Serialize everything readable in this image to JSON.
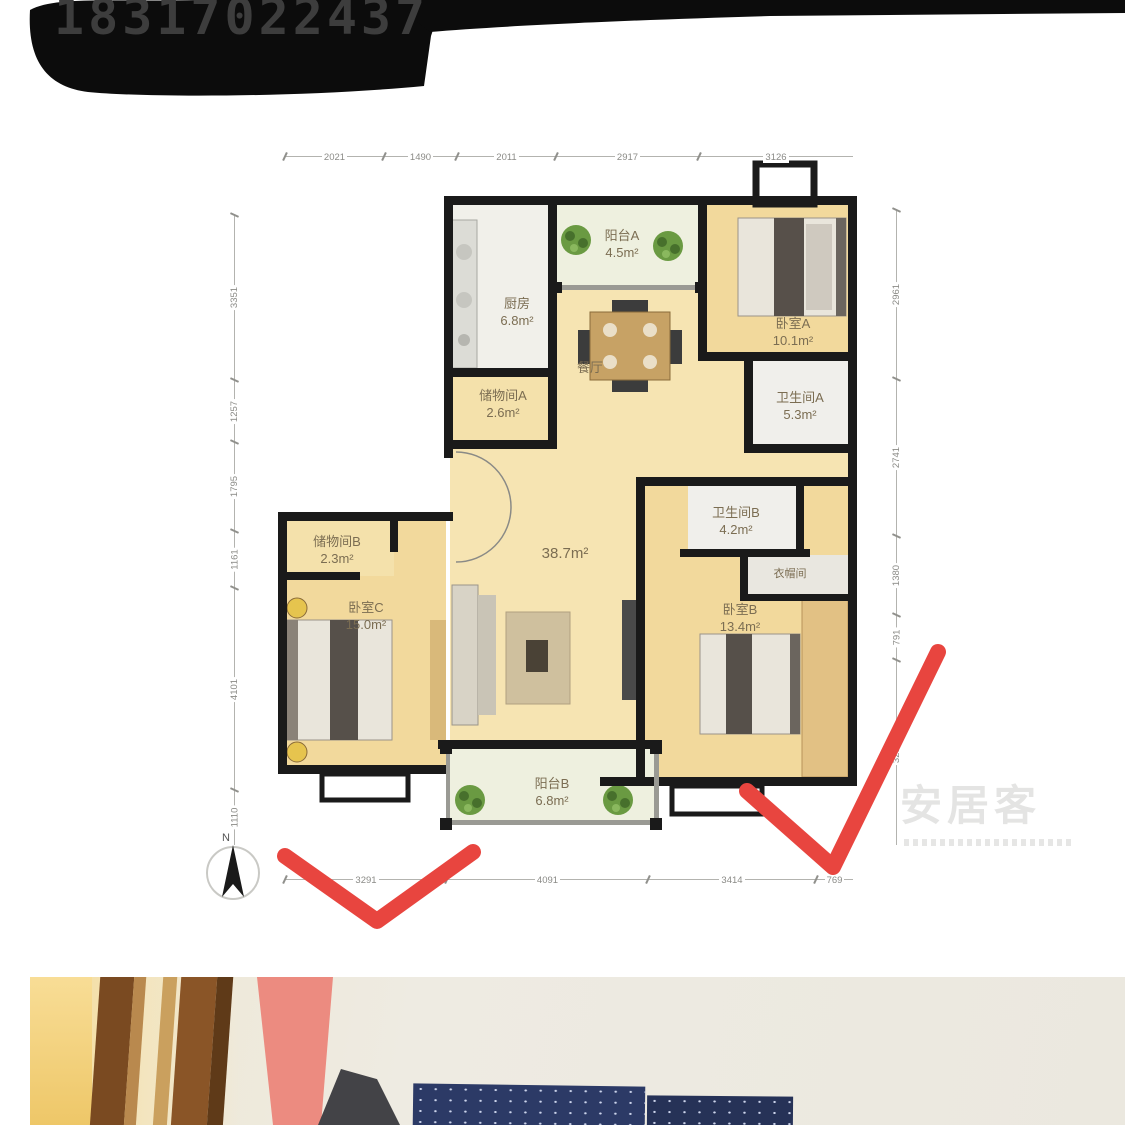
{
  "overlay": {
    "phone_number": "18317022437"
  },
  "floor_plan": {
    "compass_label": "N",
    "watermark_text": "安居客",
    "rooms": [
      {
        "name": "阳台A",
        "area": "4.5m²"
      },
      {
        "name": "厨房",
        "area": "6.8m²"
      },
      {
        "name": "卧室A",
        "area": "10.1m²"
      },
      {
        "name": "储物间A",
        "area": "2.6m²"
      },
      {
        "name": "卫生间A",
        "area": "5.3m²"
      },
      {
        "name": "餐厅",
        "area": ""
      },
      {
        "name": "",
        "area": "38.7m²"
      },
      {
        "name": "储物间B",
        "area": "2.3m²"
      },
      {
        "name": "卧室C",
        "area": "15.0m²"
      },
      {
        "name": "卫生间B",
        "area": "4.2m²"
      },
      {
        "name": "衣帽间",
        "area": ""
      },
      {
        "name": "卧室B",
        "area": "13.4m²"
      },
      {
        "name": "阳台B",
        "area": "6.8m²"
      }
    ],
    "dimensions": {
      "top": [
        "2021",
        "1490",
        "2011",
        "2917",
        "3126"
      ],
      "bottom": [
        "3291",
        "4091",
        "3414",
        "769"
      ],
      "left": [
        "3351",
        "1257",
        "1795",
        "1161",
        "4101",
        "1110"
      ],
      "right": [
        "2961",
        "2741",
        "1380",
        "791",
        "3231"
      ]
    }
  }
}
